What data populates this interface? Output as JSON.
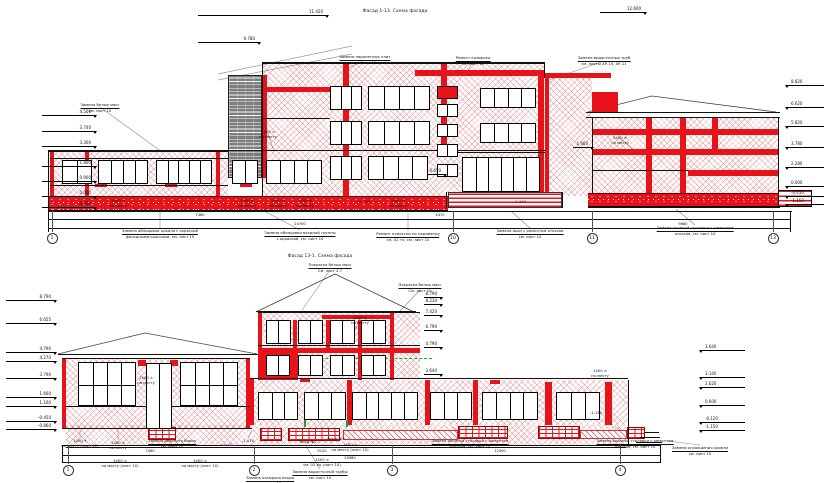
{
  "titles": {
    "top": "Фасад 1-13. Схема фасада",
    "bottom": "Фасад 13-1. Схема фасада"
  },
  "colors": {
    "repair_red": "#e8121a",
    "hatch_red": "#e2222c",
    "green_level": "#15a33b",
    "gray_brick": "#7d7d7d",
    "line_black": "#111111",
    "pink_note": "#cc44aa"
  },
  "top": {
    "axes": {
      "y": 238,
      "ground": 211,
      "items": [
        {
          "label": "1",
          "x": 52
        },
        {
          "label": "10",
          "x": 453
        },
        {
          "label": "11",
          "x": 592
        },
        {
          "label": "13",
          "x": 773
        }
      ]
    },
    "markers": [
      {
        "v": "11.420",
        "x": 198,
        "y": 15,
        "side": "l",
        "len": 130
      },
      {
        "v": "9.780",
        "x": 198,
        "y": 42,
        "side": "l",
        "len": 62
      },
      {
        "v": "12.600",
        "x": 600,
        "y": 12,
        "side": "l",
        "len": 46
      },
      {
        "v": "4.500",
        "x": 42,
        "y": 115,
        "side": "l",
        "len": 54
      },
      {
        "v": "3.740",
        "x": 42,
        "y": 131,
        "side": "l",
        "len": 54
      },
      {
        "v": "3.300",
        "x": 42,
        "y": 146,
        "side": "l",
        "len": 54
      },
      {
        "v": "1.800",
        "x": 42,
        "y": 166,
        "side": "l",
        "len": 54
      },
      {
        "v": "0.900",
        "x": 42,
        "y": 181,
        "side": "l",
        "len": 54
      },
      {
        "v": "0.000",
        "x": 42,
        "y": 196,
        "side": "l",
        "len": 54
      },
      {
        "v": "-0.450",
        "x": 42,
        "y": 207,
        "side": "l",
        "len": 54
      },
      {
        "v": "-0.450",
        "x": 428,
        "y": 174,
        "side": "l",
        "len": 18
      },
      {
        "v": "1.660",
        "x": 573,
        "y": 147,
        "side": "l",
        "len": 20
      },
      {
        "v": "8.820",
        "x": 786,
        "y": 85,
        "side": "r",
        "len": 38
      },
      {
        "v": "6.620",
        "x": 786,
        "y": 107,
        "side": "r",
        "len": 38
      },
      {
        "v": "5.820",
        "x": 786,
        "y": 126,
        "side": "r",
        "len": 38
      },
      {
        "v": "3.780",
        "x": 786,
        "y": 147,
        "side": "r",
        "len": 38
      },
      {
        "v": "2.280",
        "x": 786,
        "y": 167,
        "side": "r",
        "len": 38
      },
      {
        "v": "0.000",
        "x": 786,
        "y": 186,
        "side": "r",
        "len": 38
      },
      {
        "v": "-0.450",
        "x": 786,
        "y": 196,
        "side": "r",
        "len": 38
      },
      {
        "v": "-1.150",
        "x": 786,
        "y": 204,
        "side": "r",
        "len": 38
      }
    ],
    "dims": [
      {
        "t": "7460",
        "x": 200,
        "y": 213
      },
      {
        "t": "4470",
        "x": 440,
        "y": 213
      },
      {
        "t": "24700",
        "x": 300,
        "y": 222
      },
      {
        "t": "9680",
        "x": 683,
        "y": 222
      }
    ],
    "notes": [
      {
        "x": 100,
        "y": 103,
        "ul": true,
        "lines": [
          "Замена белых масс",
          "см. лист 10"
        ]
      },
      {
        "x": 268,
        "y": 130,
        "lines": [
          "1400 ×",
          "по месту"
        ]
      },
      {
        "x": 365,
        "y": 55,
        "ul": true,
        "lines": [
          "Замена парапетных плит",
          "см. лист 10"
        ]
      },
      {
        "x": 473,
        "y": 56,
        "ul": true,
        "lines": [
          "Ремонт козырька",
          "см. лист 10"
        ]
      },
      {
        "x": 604,
        "y": 56,
        "ul": true,
        "lines": [
          "Замена водосточных труб",
          "см. листы АР-10, АР-11"
        ]
      },
      {
        "x": 620,
        "y": 136,
        "lines": [
          "1400 ×",
          "по месту"
        ]
      },
      {
        "x": 118,
        "y": 199,
        "lines": [
          "1400 ×",
          "по месту"
        ]
      },
      {
        "x": 247,
        "y": 199,
        "lines": [
          "1400 ×",
          "по месту"
        ]
      },
      {
        "x": 278,
        "y": 199,
        "lines": [
          "1400 ×",
          "по месту"
        ]
      },
      {
        "x": 305,
        "y": 199,
        "lines": [
          "1400 ×",
          "по месту"
        ]
      },
      {
        "x": 398,
        "y": 199,
        "lines": [
          "1400 ×",
          "по месту"
        ]
      },
      {
        "x": 364,
        "y": 200,
        "lines": [
          "-1.150"
        ]
      },
      {
        "x": 520,
        "y": 200,
        "lines": [
          "-1.150"
        ]
      },
      {
        "x": 160,
        "y": 229,
        "ul": true,
        "lines": [
          "Замена облицовки цоколя с окраской",
          "фасадными красками, см. лист 10"
        ]
      },
      {
        "x": 300,
        "y": 231,
        "ul": true,
        "lines": [
          "Замена облицовки входной группы",
          "с окраской, см. лист 10"
        ]
      },
      {
        "x": 408,
        "y": 232,
        "ul": true,
        "lines": [
          "Ремонт отмостки по периметру",
          "см. 02 то, см. лист 10"
        ]
      },
      {
        "x": 530,
        "y": 229,
        "ul": true,
        "lines": [
          "Замена окон с ремонтом откосов",
          "см. лист 10"
        ]
      },
      {
        "x": 695,
        "y": 226,
        "ul": true,
        "lines": [
          "Замена оконной столярки с ремонтом",
          "откосов, см. лист 10"
        ]
      }
    ]
  },
  "bottom": {
    "axes": {
      "y": 470,
      "ground": 445,
      "items": [
        {
          "label": "1",
          "x": 68
        },
        {
          "label": "2",
          "x": 254
        },
        {
          "label": "3",
          "x": 392
        },
        {
          "label": "4",
          "x": 620
        }
      ]
    },
    "markers": [
      {
        "v": "8.790",
        "x": 6,
        "y": 300,
        "side": "l",
        "len": 50
      },
      {
        "v": "6.655",
        "x": 6,
        "y": 323,
        "side": "l",
        "len": 50
      },
      {
        "v": "4.790",
        "x": 6,
        "y": 352,
        "side": "l",
        "len": 50
      },
      {
        "v": "4.270",
        "x": 6,
        "y": 361,
        "side": "l",
        "len": 50
      },
      {
        "v": "3.790",
        "x": 6,
        "y": 378,
        "side": "l",
        "len": 50
      },
      {
        "v": "1.660",
        "x": 6,
        "y": 397,
        "side": "l",
        "len": 50
      },
      {
        "v": "1.160",
        "x": 6,
        "y": 406,
        "side": "l",
        "len": 50
      },
      {
        "v": "-0.450",
        "x": 6,
        "y": 421,
        "side": "l",
        "len": 50
      },
      {
        "v": "-0.860",
        "x": 6,
        "y": 429,
        "side": "l",
        "len": 50
      },
      {
        "v": "8.790",
        "x": 424,
        "y": 297,
        "side": "l",
        "len": 18
      },
      {
        "v": "8.230",
        "x": 424,
        "y": 304,
        "side": "l",
        "len": 18
      },
      {
        "v": "7.420",
        "x": 424,
        "y": 315,
        "side": "l",
        "len": 18
      },
      {
        "v": "6.790",
        "x": 424,
        "y": 330,
        "side": "l",
        "len": 18
      },
      {
        "v": "4.790",
        "x": 424,
        "y": 347,
        "side": "l",
        "len": 18
      },
      {
        "v": "3.640",
        "x": 424,
        "y": 374,
        "side": "l",
        "len": 18
      },
      {
        "v": "3.640",
        "x": 700,
        "y": 350,
        "side": "r",
        "len": 45
      },
      {
        "v": "3.140",
        "x": 700,
        "y": 377,
        "side": "r",
        "len": 45
      },
      {
        "v": "2.620",
        "x": 700,
        "y": 387,
        "side": "r",
        "len": 45
      },
      {
        "v": "0.600",
        "x": 700,
        "y": 405,
        "side": "r",
        "len": 45
      },
      {
        "v": "-0.120",
        "x": 700,
        "y": 422,
        "side": "r",
        "len": 45
      },
      {
        "v": "-1.150",
        "x": 700,
        "y": 430,
        "side": "r",
        "len": 45
      }
    ],
    "dims": [
      {
        "t": "7460",
        "x": 150,
        "y": 449
      },
      {
        "t": "9120",
        "x": 322,
        "y": 449
      },
      {
        "t": "12400",
        "x": 500,
        "y": 449
      },
      {
        "t": "29980",
        "x": 350,
        "y": 456
      }
    ],
    "notes": [
      {
        "x": 330,
        "y": 263,
        "ul": true,
        "lines": [
          "Покраска белых масс",
          "См. лист 4.7"
        ]
      },
      {
        "x": 420,
        "y": 283,
        "ul": true,
        "lines": [
          "Покраска белых масс",
          "См. лист 10"
        ]
      },
      {
        "x": 360,
        "y": 316,
        "lines": [
          "1400 ×",
          "по месту"
        ]
      },
      {
        "x": 146,
        "y": 376,
        "lines": [
          "1400 ×",
          "по месту"
        ]
      },
      {
        "x": 80,
        "y": 439,
        "lines": [
          "1400 ×",
          "по месту (лист 10)"
        ]
      },
      {
        "x": 118,
        "y": 441,
        "lines": [
          "1400 ×",
          "по месту"
        ]
      },
      {
        "x": 172,
        "y": 439,
        "ul": true,
        "lines": [
          "Замена дверного блока",
          "см. лист 10"
        ]
      },
      {
        "x": 228,
        "y": 443,
        "color": "#cc44aa",
        "lines": [
          "тип №1"
        ]
      },
      {
        "x": 248,
        "y": 439,
        "lines": [
          "-1.070"
        ]
      },
      {
        "x": 308,
        "y": 440,
        "lines": [
          "Вход №2"
        ]
      },
      {
        "x": 336,
        "y": 437,
        "lines": [
          "Вход №3"
        ]
      },
      {
        "x": 350,
        "y": 443,
        "lines": [
          "1400 ×",
          "по месту (лист 10)"
        ]
      },
      {
        "x": 470,
        "y": 439,
        "ul": true,
        "lines": [
          "Замена оконной столярки с ремонтом",
          "откосов, см. лист 10"
        ]
      },
      {
        "x": 635,
        "y": 439,
        "ul": true,
        "lines": [
          "Замена оконной столярки с ремонтом",
          "откосов, см. лист 10"
        ]
      },
      {
        "x": 120,
        "y": 459,
        "lines": [
          "1400 ×",
          "по месту (лист 10)"
        ]
      },
      {
        "x": 200,
        "y": 459,
        "lines": [
          "1400 ×",
          "по месту (лист 10)"
        ]
      },
      {
        "x": 322,
        "y": 458,
        "lines": [
          "1400 ×",
          "см. 02 по (лист 10)"
        ]
      },
      {
        "x": 320,
        "y": 470,
        "ul": true,
        "lines": [
          "Замена водосточной трубы",
          "см. лист 10"
        ]
      },
      {
        "x": 270,
        "y": 476,
        "ul": true,
        "lines": [
          "Замена козырька входа",
          "см. лист 10"
        ]
      },
      {
        "x": 700,
        "y": 446,
        "ul": true,
        "lines": [
          "Замена ограждения кровли",
          "см. лист 10"
        ]
      },
      {
        "x": 600,
        "y": 369,
        "lines": [
          "1400 ×",
          "по месту"
        ]
      },
      {
        "x": 596,
        "y": 411,
        "lines": [
          "-1.150"
        ]
      }
    ]
  }
}
